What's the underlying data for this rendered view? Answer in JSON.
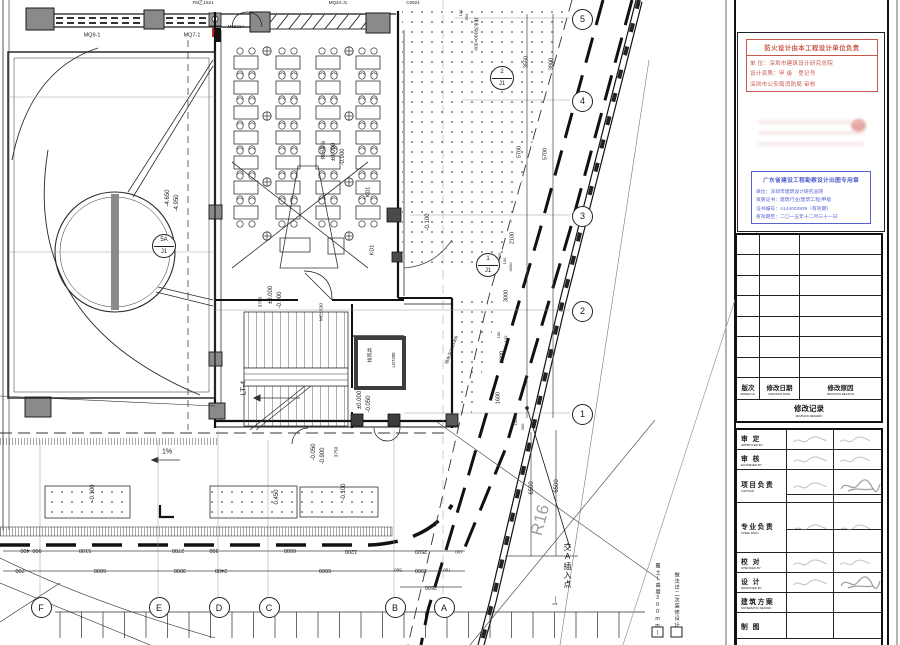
{
  "plan": {
    "labels": [
      [
        "FM乙1521",
        203,
        3,
        0,
        4.5
      ],
      [
        "M1521A",
        236,
        27,
        0,
        4.5
      ],
      [
        "MQ24-J1",
        338,
        3,
        0,
        4.5
      ],
      [
        "C0924",
        413,
        3,
        0,
        4.5
      ],
      [
        "MQ9-1",
        92,
        36,
        0,
        5.5
      ],
      [
        "MQ7-1",
        192,
        36,
        0,
        5.5
      ],
      [
        "-4.650",
        168,
        198,
        -90,
        6
      ],
      [
        "-4.950",
        177,
        203,
        -90,
        6
      ],
      [
        "休闲平台",
        325,
        150,
        -90,
        4.8
      ],
      [
        "±0.000",
        334,
        152,
        -90,
        6
      ],
      [
        "-0.900",
        343,
        157,
        -90,
        6
      ],
      [
        "KD1",
        369,
        192,
        -90,
        5.5
      ],
      [
        "KD1",
        373,
        250,
        -90,
        5.5
      ],
      [
        "排水沟300×300",
        474,
        34,
        90,
        4.8
      ],
      [
        "-0.100",
        428,
        222,
        -90,
        6
      ],
      [
        "±0.000",
        271,
        295,
        -90,
        6
      ],
      [
        "-0.900",
        280,
        300,
        -90,
        6
      ],
      [
        "3700",
        262,
        302,
        -90,
        4.8
      ],
      [
        "MC1530",
        323,
        312,
        -90,
        4.8
      ],
      [
        "LT-4",
        243,
        388,
        -90,
        7.5
      ],
      [
        "排风井",
        371,
        355,
        -90,
        5
      ],
      [
        "LD7200",
        394,
        360,
        -90,
        4.3
      ],
      [
        "±0.000",
        360,
        400,
        -90,
        6
      ],
      [
        "-0.050",
        369,
        404,
        -90,
        6
      ],
      [
        "-0.050",
        314,
        452,
        -90,
        6
      ],
      [
        "-0.900",
        323,
        456,
        -90,
        6
      ],
      [
        "3750",
        338,
        452,
        -90,
        4.8
      ],
      [
        "-0.100",
        93,
        493,
        -90,
        6
      ],
      [
        "0.450",
        277,
        497,
        -90,
        6
      ],
      [
        "-0.100",
        344,
        492,
        -90,
        6
      ],
      [
        "1%",
        167,
        452,
        0,
        7
      ],
      [
        "R16",
        540,
        520,
        -75,
        17,
        "#9d9d9d"
      ],
      [
        "交A插入点",
        567,
        566,
        0,
        8,
        "#111",
        "v"
      ],
      [
        "1—",
        556,
        601,
        -90,
        6
      ],
      [
        "排水沟300×300",
        452,
        350,
        -70,
        4.3
      ],
      [
        "3550",
        527,
        62,
        -90,
        5.5
      ],
      [
        "3900",
        552,
        64,
        -90,
        5.5
      ],
      [
        "5700",
        520,
        152,
        -90,
        5.5
      ],
      [
        "5700",
        546,
        154,
        -90,
        5.5
      ],
      [
        "2100",
        513,
        238,
        -90,
        5.5
      ],
      [
        "400",
        500,
        256,
        -90,
        4
      ],
      [
        "100",
        505,
        261,
        -90,
        4
      ],
      [
        "4500",
        511,
        267,
        -90,
        4
      ],
      [
        "3000",
        507,
        296,
        -90,
        5.5
      ],
      [
        "100",
        499,
        335,
        -90,
        4
      ],
      [
        "100",
        506,
        339,
        -90,
        4
      ],
      [
        "2000",
        503,
        357,
        -90,
        5.5
      ],
      [
        "1600",
        499,
        398,
        -90,
        5.5
      ],
      [
        "1000",
        516,
        421,
        -90,
        4
      ],
      [
        "300",
        523,
        427,
        -90,
        4
      ],
      [
        "6500",
        532,
        488,
        -90,
        6
      ],
      [
        "6500",
        557,
        486,
        -90,
        6
      ],
      [
        "100",
        461,
        13,
        -90,
        4
      ],
      [
        "550",
        467,
        17,
        -90,
        4
      ],
      [
        "400",
        25,
        549,
        180,
        5.5
      ],
      [
        "900",
        37,
        549,
        180,
        5.5
      ],
      [
        "5100",
        85,
        549,
        180,
        5.5
      ],
      [
        "2700",
        178,
        549,
        180,
        5.5
      ],
      [
        "300",
        214,
        549,
        180,
        5.5
      ],
      [
        "6600",
        290,
        549,
        180,
        5.5
      ],
      [
        "1200",
        351,
        550,
        180,
        5.5
      ],
      [
        "2500",
        421,
        550,
        180,
        5.5
      ],
      [
        "100",
        459,
        551,
        180,
        4.5
      ],
      [
        "700",
        20,
        569,
        180,
        5.5
      ],
      [
        "6000",
        100,
        569,
        180,
        5.5
      ],
      [
        "3000",
        180,
        569,
        180,
        5.5
      ],
      [
        "2400",
        221,
        569,
        180,
        5.5
      ],
      [
        "6000",
        325,
        569,
        180,
        5.5
      ],
      [
        "500",
        398,
        569,
        180,
        4.5
      ],
      [
        "1900",
        421,
        569,
        180,
        5.5
      ],
      [
        "700",
        447,
        569,
        180,
        4.5
      ],
      [
        "2600",
        431,
        586,
        180,
        5.5
      ]
    ],
    "grid_letters": [
      [
        "F",
        40
      ],
      [
        "E",
        158
      ],
      [
        "D",
        218
      ],
      [
        "C",
        268
      ],
      [
        "B",
        394
      ],
      [
        "A",
        443
      ]
    ],
    "grid_numbers": [
      [
        "5",
        18
      ],
      [
        "4",
        100
      ],
      [
        "3",
        215
      ],
      [
        "2",
        310
      ],
      [
        "1",
        413
      ]
    ],
    "detail_bubbles": [
      [
        "2",
        "J1",
        501,
        77
      ],
      [
        "1",
        "J1",
        487,
        264
      ],
      [
        "5A",
        "J1",
        163,
        245
      ]
    ],
    "legend": [
      {
        "text": "覆土(高度300mm)"
      },
      {
        "text": "做法详二次装修设计"
      }
    ]
  },
  "titleblock": {
    "stamp_red": {
      "l1": "防火设计由本工程设计单位负责",
      "l2": "单 位：深圳市建筑设计研究总院",
      "l3": "设计资质：甲 级　登记号",
      "l4": "深圳市公安局消防局 审核"
    },
    "stamp_blue": {
      "title": "广东省建设工程勘察设计出图专用章",
      "l1": "单位：深圳市建筑设计研究总院",
      "l2": "资质证书：建筑行业(建筑工程)甲级",
      "l3": "证书编号：A144003939（有效期）",
      "l4": "有效期至：二〇一五年十二月三十一日"
    },
    "revision": {
      "cols": [
        {
          "cn": "版次",
          "en": "ORDER No."
        },
        {
          "cn": "修改日期",
          "en": "REVISION DATE"
        },
        {
          "cn": "修改原因",
          "en": "REVISION REASON"
        }
      ],
      "footer": {
        "cn": "修改记录",
        "en": "REVISION REMARK"
      }
    },
    "personnel": [
      {
        "cn": "审 定",
        "en": "APPROVED BY"
      },
      {
        "cn": "审 核",
        "en": "EXAMINED BY"
      },
      {
        "cn": "项目负责",
        "en": "CAPTAIN"
      },
      {
        "cn": "专业负责",
        "en": "CHIEF ENGI."
      },
      {
        "cn": "校 对",
        "en": "CHECKED BY"
      },
      {
        "cn": "设 计",
        "en": "DESIGNED BY"
      },
      {
        "cn": "建筑方案",
        "en": "SCHEMATIC DESIGN"
      },
      {
        "cn": "制 图",
        "en": ""
      }
    ]
  }
}
